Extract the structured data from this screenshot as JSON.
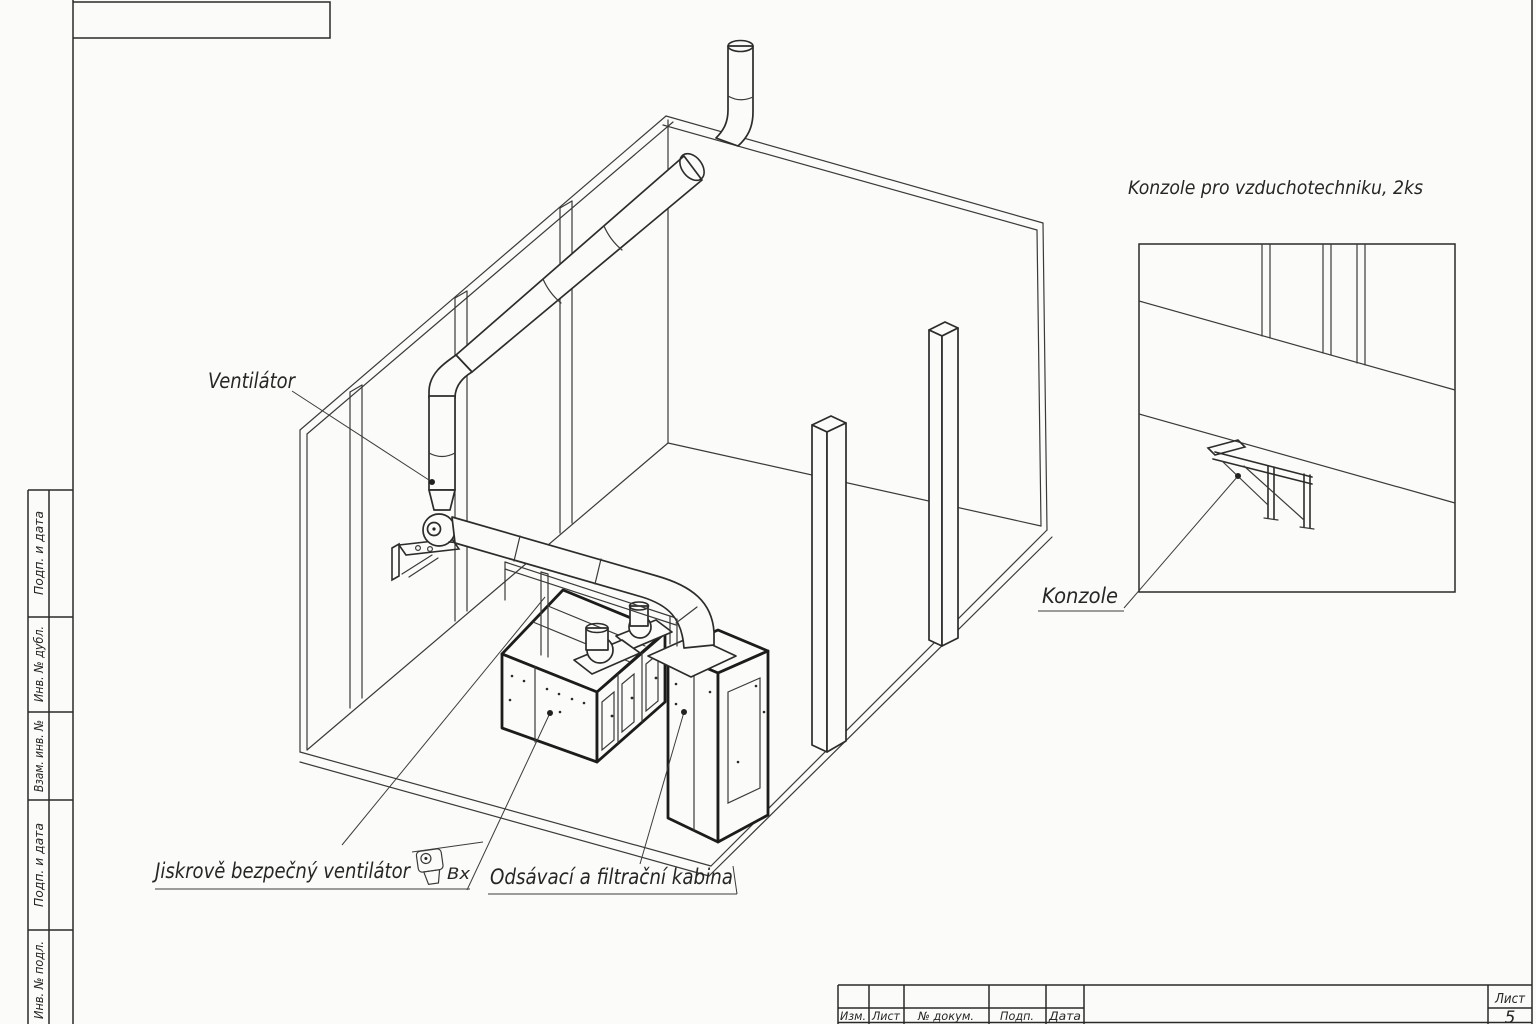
{
  "labels": {
    "ventilator": "Ventilátor",
    "konzole_title": "Konzole pro vzduchotechniku, 2ks",
    "konzole": "Konzole",
    "spark_fan": "Jiskrově bezpečný ventilátor",
    "spark_fan_suffix": "Вх",
    "suction_cabin": "Odsávací a filtrační kabina"
  },
  "sidebar": {
    "items": [
      {
        "label": "Подп. и дата"
      },
      {
        "label": "Инв. № дубл."
      },
      {
        "label": "Взам. инв. №"
      },
      {
        "label": "Подп. и дата"
      },
      {
        "label": "Инв. № подл."
      }
    ]
  },
  "title_block": {
    "columns": [
      {
        "label": "Изм."
      },
      {
        "label": "Лист"
      },
      {
        "label": "№ докум."
      },
      {
        "label": "Подп."
      },
      {
        "label": "Дата"
      }
    ],
    "sheet_label": "Лист",
    "sheet_number": "5"
  },
  "icons": {
    "fan_inlet": "fan-inlet-symbol"
  },
  "colors": {
    "line": "#2c2c2c",
    "bold_line": "#1c1c1c",
    "background": "#fbfbf9"
  }
}
